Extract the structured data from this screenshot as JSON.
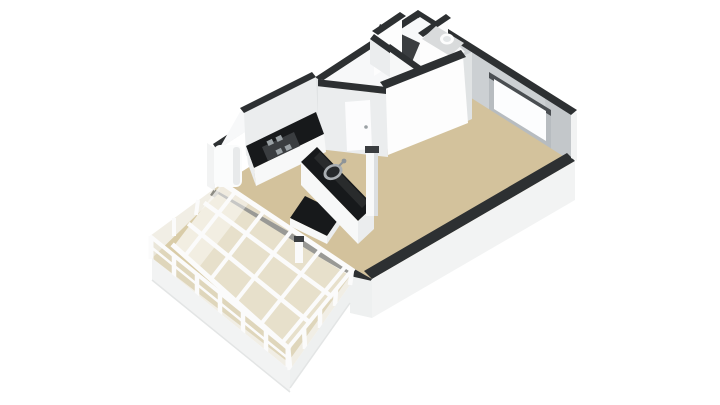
{
  "scene": {
    "description": "3D dollhouse-style isometric floor plan render of a small apartment, empty of furniture, viewed from above at an angle on a plain white background",
    "style": "architectural 3D floorplan render",
    "background": "#ffffff",
    "text_visible": "none"
  },
  "rooms": [
    {
      "id": "living-room",
      "floor": "tan",
      "features": [
        "window-on-upper-right-wall"
      ]
    },
    {
      "id": "kitchen",
      "floor": "tan",
      "features": [
        "l-shaped-black-counter",
        "hob",
        "sink",
        "island-block",
        "fridge",
        "extractor-column"
      ]
    },
    {
      "id": "hallway",
      "floor": "tan",
      "features": [
        "interior-door"
      ]
    },
    {
      "id": "bathroom",
      "floor": "hidden",
      "features": []
    },
    {
      "id": "toilet-room",
      "floor": "gray",
      "features": [
        "toilet"
      ]
    },
    {
      "id": "storage-closet",
      "floor": "dark",
      "features": [
        "open-dark-doorway"
      ]
    },
    {
      "id": "conservatory",
      "floor": "tan",
      "features": [
        "glass-walls",
        "glass-roof-beam-grid",
        "white-mullions",
        "white-base-siding"
      ]
    }
  ],
  "colors": {
    "bg": "#ffffff",
    "floor": "#d3c29c",
    "floor_cons": "#d9cca8",
    "floor_bath": "#d9dbdc",
    "band": "#2d3032",
    "face_bright": "#fdfdfd",
    "face_light": "#ebedee",
    "face_mid": "#e0e3e4",
    "face_shadow": "#ccd0d3",
    "face_shadow2": "#bcc1c4",
    "ext": "#f2f3f3",
    "ext2": "#eef0f0",
    "counter": "#17191b",
    "white": "#f7f8f8",
    "glass": "rgba(228,222,206,0.52)",
    "glass_roof": "rgba(243,240,231,0.55)",
    "beam": "#fbfbfb",
    "beam_edge": "#e3e5e5",
    "window_glass": "#fcfdfe",
    "window_frame": "#b7bcc0",
    "reveal": "#4a4e52",
    "appliance": "#8f979c",
    "dark_fixture": "#3a3d40",
    "cover": "#f7f8f9",
    "sill": "#f0f2f3"
  }
}
